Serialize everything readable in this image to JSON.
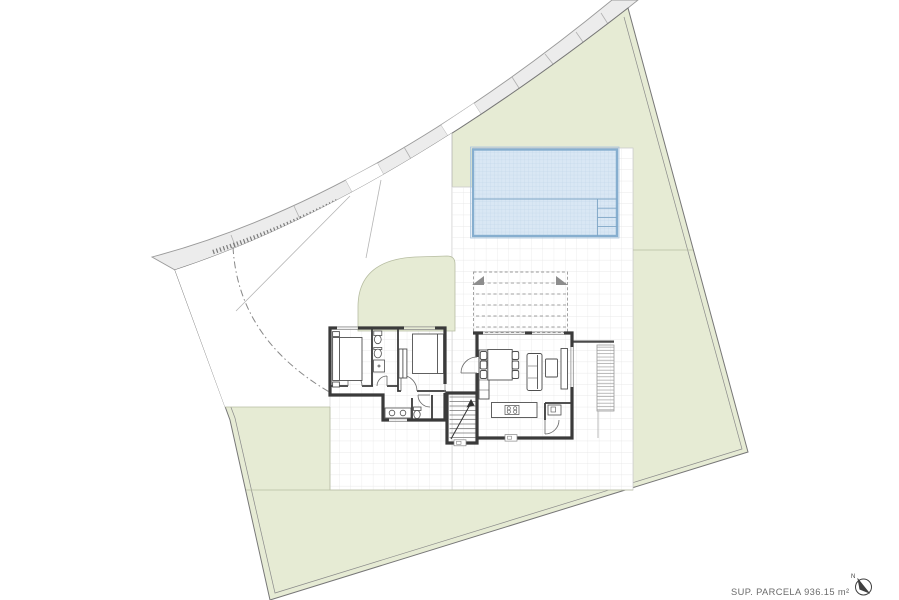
{
  "annotations": {
    "area_label": "SUP. PARCELA 936.15 m²",
    "north_label": "N"
  },
  "colors": {
    "parcel_green": "#e6ebd4",
    "green_border": "#b7bda2",
    "street_gray": "#ececec",
    "street_border": "#9a9a9a",
    "pool_fill": "#d9e7f4",
    "pool_tile": "#bdd3e7",
    "pool_border": "#86aecf",
    "wall_dark": "#3a3a3a",
    "grid_line": "#e4e4e4",
    "furniture_line": "#4f4f4f",
    "label_text": "#6b6b6b"
  },
  "features": {
    "street": "curved-street-sidewalk-band",
    "parcel": "irregular-plot-boundary",
    "driveway": "driveway-with-turning-path",
    "garden": "lawn-areas",
    "pool": "tiled-swimming-pool-with-steps",
    "terrace": "gridded-terrace-paving",
    "pergola": "dashed-slatted-pergola",
    "house": "single-storey-villa-floor-plan",
    "rooms": [
      "bedroom-1",
      "bathroom-1",
      "bedroom-2",
      "hall",
      "bathroom-2",
      "stairs",
      "living-dining-kitchen",
      "pantry"
    ],
    "deck": "louvered-side-deck",
    "north_arrow": "compass-north-arrow"
  }
}
